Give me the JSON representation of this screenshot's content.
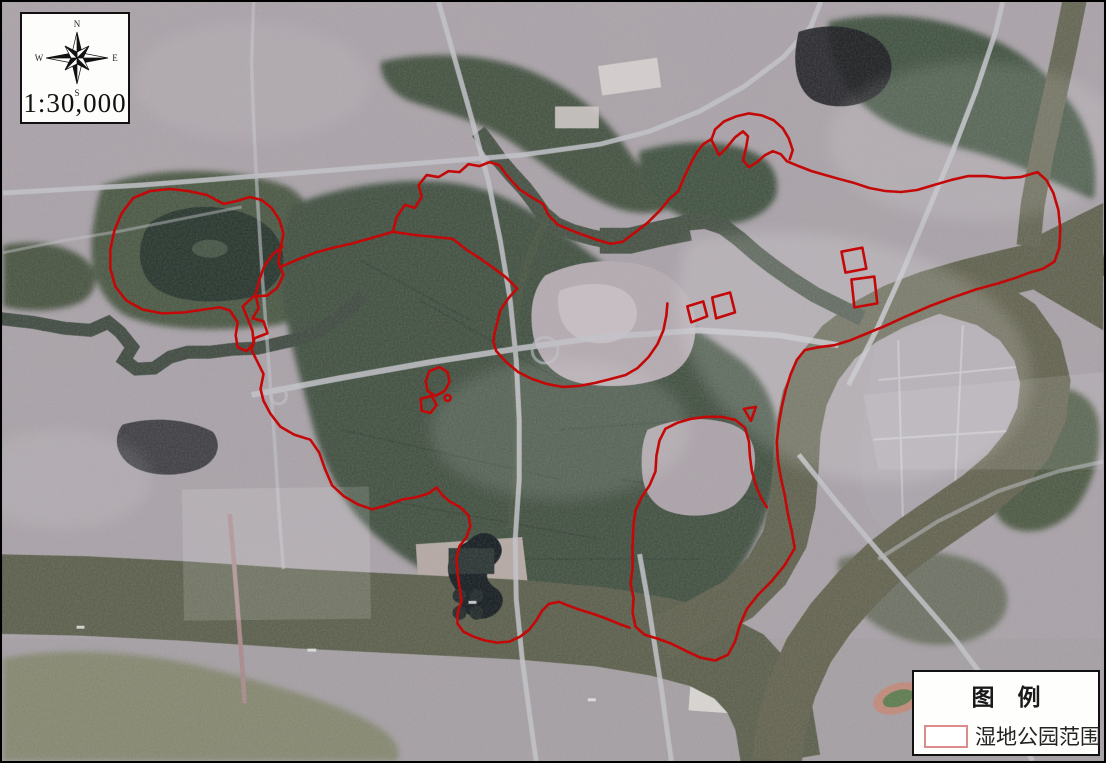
{
  "map_overlay": {
    "scale_label": "1:30,000",
    "compass": {
      "north": "N",
      "east": "E",
      "south": "S",
      "west": "W"
    },
    "legend": {
      "title": "图　例",
      "items": [
        {
          "label": "湿地公园范围"
        }
      ]
    }
  },
  "palette": {
    "boundary_red": "#c40808",
    "legend_swatch_border": "#dd8b8b",
    "map_border": "#000000",
    "river": "#585c48",
    "wetland_green": "#3c4e3c"
  }
}
